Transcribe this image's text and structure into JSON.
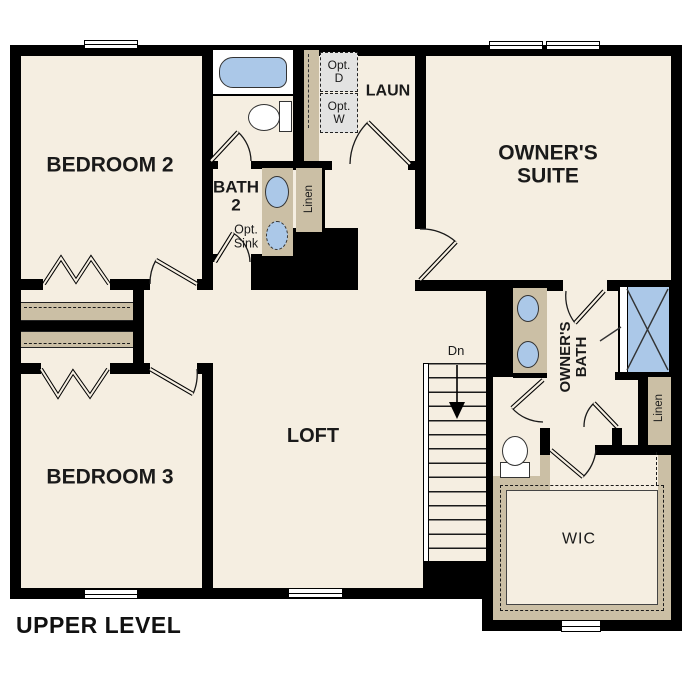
{
  "plan": {
    "title": "UPPER LEVEL",
    "rooms": {
      "bedroom2": "BEDROOM 2",
      "bedroom3": "BEDROOM 3",
      "bath2_line1": "BATH",
      "bath2_line2": "2",
      "laundry": "LAUN",
      "suite_line1": "OWNER'S",
      "suite_line2": "SUITE",
      "loft": "LOFT",
      "owners_bath_line1": "OWNER'S",
      "owners_bath_line2": "BATH",
      "wic": "WIC"
    },
    "annotations": {
      "opt_sink_line1": "Opt.",
      "opt_sink_line2": "Sink",
      "opt_dryer_line1": "Opt.",
      "opt_dryer_line2": "D",
      "opt_washer_line1": "Opt.",
      "opt_washer_line2": "W",
      "linen_upper": "Linen",
      "linen_lower": "Linen",
      "stairs_down": "Dn"
    },
    "colors": {
      "floor": "#f5eee1",
      "wall": "#000000",
      "casework": "#cbbfa5",
      "fixture_blue": "#abc8e8",
      "optional_appliance": "#e3e3e2"
    }
  }
}
